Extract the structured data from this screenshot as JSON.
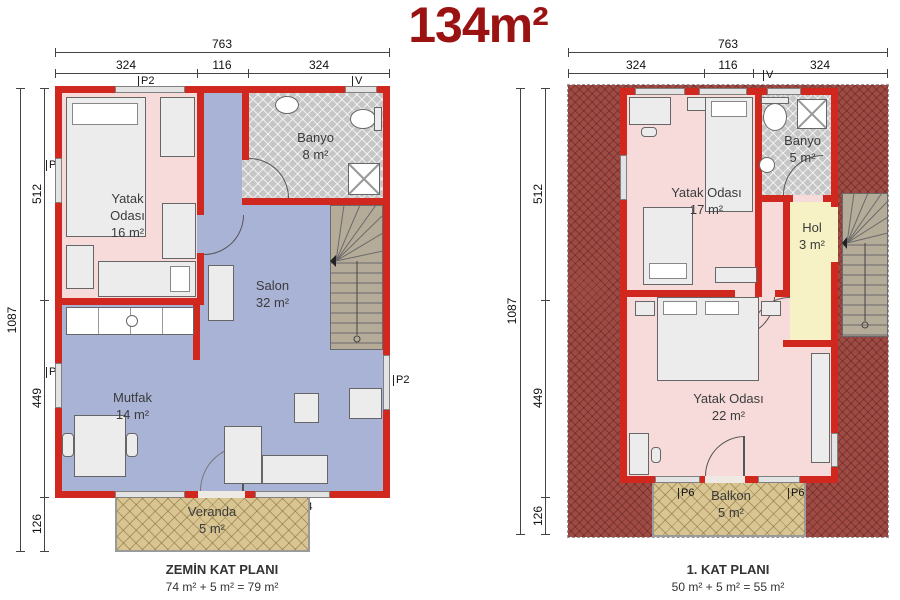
{
  "title": "134m²",
  "colors": {
    "wall_red": "#D0281F",
    "title_red": "#9B1212",
    "bedroom_pink": "#F6DBDA",
    "living_blue": "#A9B3D6",
    "bath_gray": "#C6C6C6",
    "hall_yellow": "#F7F2C5",
    "porch_tan": "#D8C592",
    "terrace_red": "#A04A44",
    "stairs_tan": "#B5AB99"
  },
  "plans": [
    {
      "footer_title": "ZEMİN KAT PLANI",
      "footer_area": "74 m² + 5 m² = 79 m²",
      "dims": {
        "width_total": "763",
        "width_segments": [
          "324",
          "116",
          "324"
        ],
        "height_total": "1087",
        "height_segments": [
          "512",
          "449",
          "126"
        ]
      },
      "rooms": [
        {
          "name": "Yatak",
          "name2": "Odası",
          "area": "16 m²"
        },
        {
          "name": "Banyo",
          "area": "8 m²"
        },
        {
          "name": "Salon",
          "area": "32 m²"
        },
        {
          "name": "Mutfak",
          "area": "14 m²"
        },
        {
          "name": "Veranda",
          "area": "5 m²"
        }
      ],
      "openings": {
        "window": "P2",
        "vent": "V",
        "porch_door": "P4"
      }
    },
    {
      "footer_title": "1. KAT PLANI",
      "footer_area": "50 m² + 5 m² = 55 m²",
      "dims": {
        "width_total": "763",
        "width_segments": [
          "324",
          "116",
          "324"
        ],
        "height_total": "1087",
        "height_segments": [
          "512",
          "449",
          "126"
        ]
      },
      "rooms": [
        {
          "name": "Yatak Odası",
          "area": "17 m²"
        },
        {
          "name": "Banyo",
          "area": "5 m²"
        },
        {
          "name": "Hol",
          "area": "3 m²"
        },
        {
          "name": "Yatak Odası",
          "area": "22 m²"
        },
        {
          "name": "Balkon",
          "area": "5 m²"
        }
      ],
      "openings": {
        "window": "P2",
        "vent": "V",
        "balcony_door": "P6"
      }
    }
  ]
}
